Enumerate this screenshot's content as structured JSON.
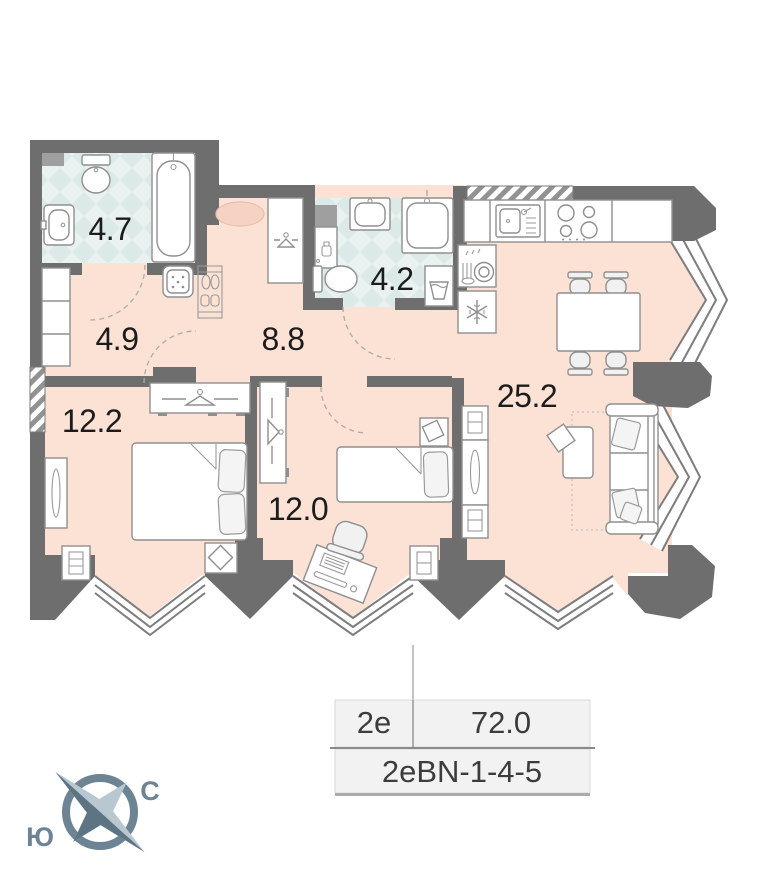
{
  "plan": {
    "rooms": [
      {
        "name": "bathroom-1",
        "area_label": "4.7"
      },
      {
        "name": "hallway",
        "area_label": "4.9"
      },
      {
        "name": "corridor",
        "area_label": "8.8"
      },
      {
        "name": "bathroom-2",
        "area_label": "4.2"
      },
      {
        "name": "bedroom-1",
        "area_label": "12.2"
      },
      {
        "name": "bedroom-2",
        "area_label": "12.0"
      },
      {
        "name": "living-kitchen",
        "area_label": "25.2"
      }
    ],
    "icons": [
      "toilet",
      "bathtub",
      "sink",
      "shower-basin",
      "laundry-basket",
      "soap-shelf",
      "water-heater",
      "shoe-rack",
      "entrance-rug",
      "wardrobe-hanger",
      "kitchen-sink",
      "stove-burners",
      "dishwasher",
      "fridge-snowflake",
      "dining-table",
      "chair",
      "sofa",
      "coffee-table",
      "double-bed",
      "single-bed",
      "desk",
      "office-chair",
      "nightstand",
      "mirror",
      "pouf",
      "shelf-unit"
    ]
  },
  "info_table": {
    "unit_type": "2е",
    "area_total": "72.0",
    "layout_code": "2еBN-1-4-5"
  },
  "compass": {
    "north": "С",
    "south": "Ю"
  },
  "colors": {
    "wall": "#6e6e6e",
    "floor": "#fce1d5",
    "tile": "#dbe9e8",
    "rug": "#f6d2c2",
    "compass": "#6d8494"
  }
}
